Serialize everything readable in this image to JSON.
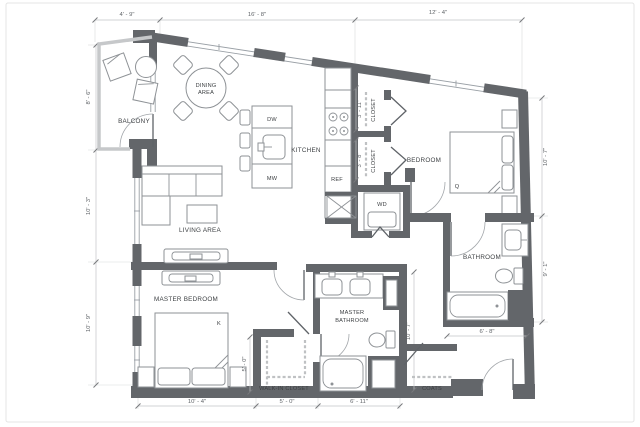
{
  "rooms": {
    "balcony": {
      "label": "BALCONY"
    },
    "dining": {
      "line1": "DINING",
      "line2": "AREA"
    },
    "kitchen": {
      "label": "KITCHEN"
    },
    "living": {
      "label": "LIVING AREA"
    },
    "master_bedroom": {
      "label": "MASTER BEDROOM",
      "bed": "K"
    },
    "master_bathroom": {
      "line1": "MASTER",
      "line2": "BATHROOM"
    },
    "walk_in_closet": {
      "label": "WALK-IN CLOSET"
    },
    "bedroom": {
      "label": "BEDROOM",
      "bed": "Q"
    },
    "bathroom": {
      "label": "BATHROOM"
    },
    "closet_upper": {
      "label": "CLOSET",
      "dim": "3' - 11\""
    },
    "closet_lower": {
      "label": "CLOSET",
      "dim": "3' - 8\""
    },
    "coats": {
      "label": "COATS"
    },
    "laundry": {
      "label": "WD"
    }
  },
  "appliances": {
    "dishwasher": "DW",
    "microwave": "MW",
    "refrigerator": "REF"
  },
  "dimensions": {
    "top": [
      "4' - 9\"",
      "16' - 8\"",
      "12' - 4\""
    ],
    "left": [
      "8' - 6\"",
      "10' - 3\"",
      "10' - 9\""
    ],
    "right": [
      "10' - 7\"",
      "9' - 1\""
    ],
    "bottom": [
      "10' - 4\"",
      "5' - 0\"",
      "6' - 11\""
    ],
    "master_bath": "10' - 7\"",
    "walk_in": "5' - 0\"",
    "bathroom": "6' - 8\""
  },
  "colors": {
    "wall": "#63666a",
    "window": "#9aa0a6",
    "dimension": "#606468",
    "furniture": "#8e9296"
  }
}
